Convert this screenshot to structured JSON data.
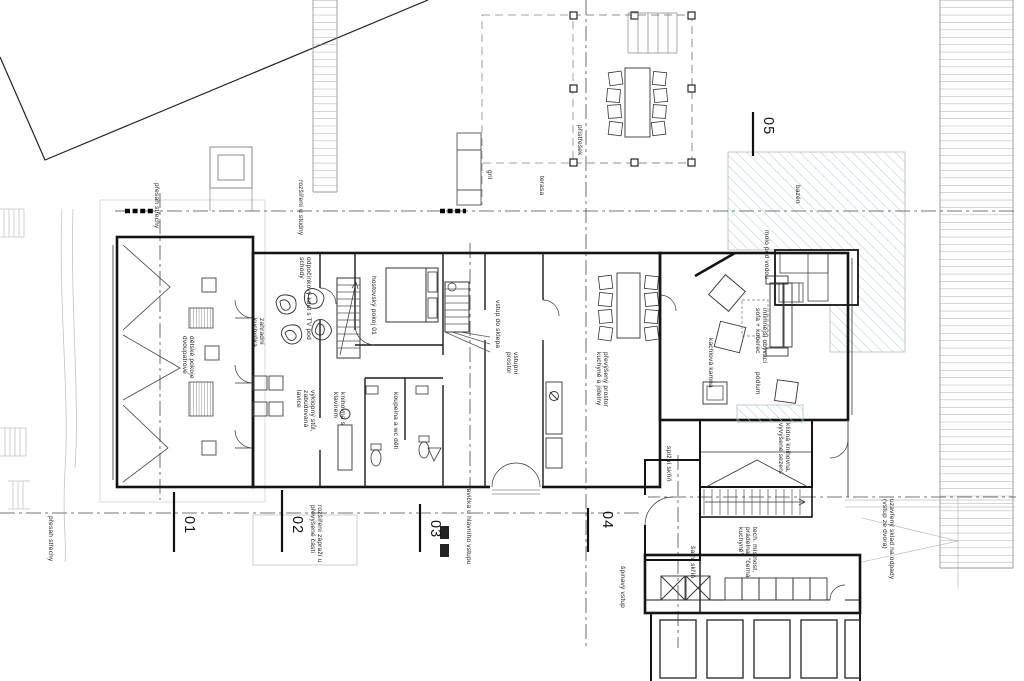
{
  "plan": {
    "labels": [
      {
        "text": "přesah střechy"
      },
      {
        "text": "rozšíření u studny"
      },
      {
        "text": "gril"
      },
      {
        "text": "terasa"
      },
      {
        "text": "přístřešek"
      },
      {
        "text": "bazén"
      },
      {
        "text": "molo pod vodou"
      },
      {
        "text": "dětské pokoje\ndvoupatrové"
      },
      {
        "text": "zahradní\nkuchyňka"
      },
      {
        "text": "odpočinkový kout s TV pod\nschody"
      },
      {
        "text": "hostovský pokoj 01"
      },
      {
        "text": "výklopný stůl,\nzabudovaná\nlavice"
      },
      {
        "text": "knihovna s\nklavírem"
      },
      {
        "text": "koupelna a wc děti"
      },
      {
        "text": "vstup do sklepa"
      },
      {
        "text": "vstupní\nprostor"
      },
      {
        "text": "převýšený prostor\nkuchyně a jídelny"
      },
      {
        "text": "kachlová kamna"
      },
      {
        "text": "intimnější obývací\nsofa + koberec"
      },
      {
        "text": "pódium"
      },
      {
        "text": "klidná knihovna,\nvyvýšené sezení"
      },
      {
        "text": "spížní skříň"
      },
      {
        "text": "šatní skříň"
      },
      {
        "text": "tech. místnost,\nprádelna, \"černá\nkuchyně\""
      },
      {
        "text": "rozšíření zápraží u\npřevýšené části"
      },
      {
        "text": "lavička u hlavního vstupu"
      },
      {
        "text": "špinavý vstup"
      },
      {
        "text": "uzavřený sklad na odpady\n(vstup ze dvora)"
      },
      {
        "text": "přesah střechy"
      }
    ],
    "section_marks": [
      {
        "label": "01"
      },
      {
        "label": "02"
      },
      {
        "label": "03"
      },
      {
        "label": "04"
      },
      {
        "label": "05"
      }
    ],
    "colors": {
      "pool_hatch": "#a9ced6",
      "wall": "#141414",
      "terrain": "#c8c8c8",
      "centerline": "#4a4a4a",
      "paper": "#ffffff"
    }
  }
}
